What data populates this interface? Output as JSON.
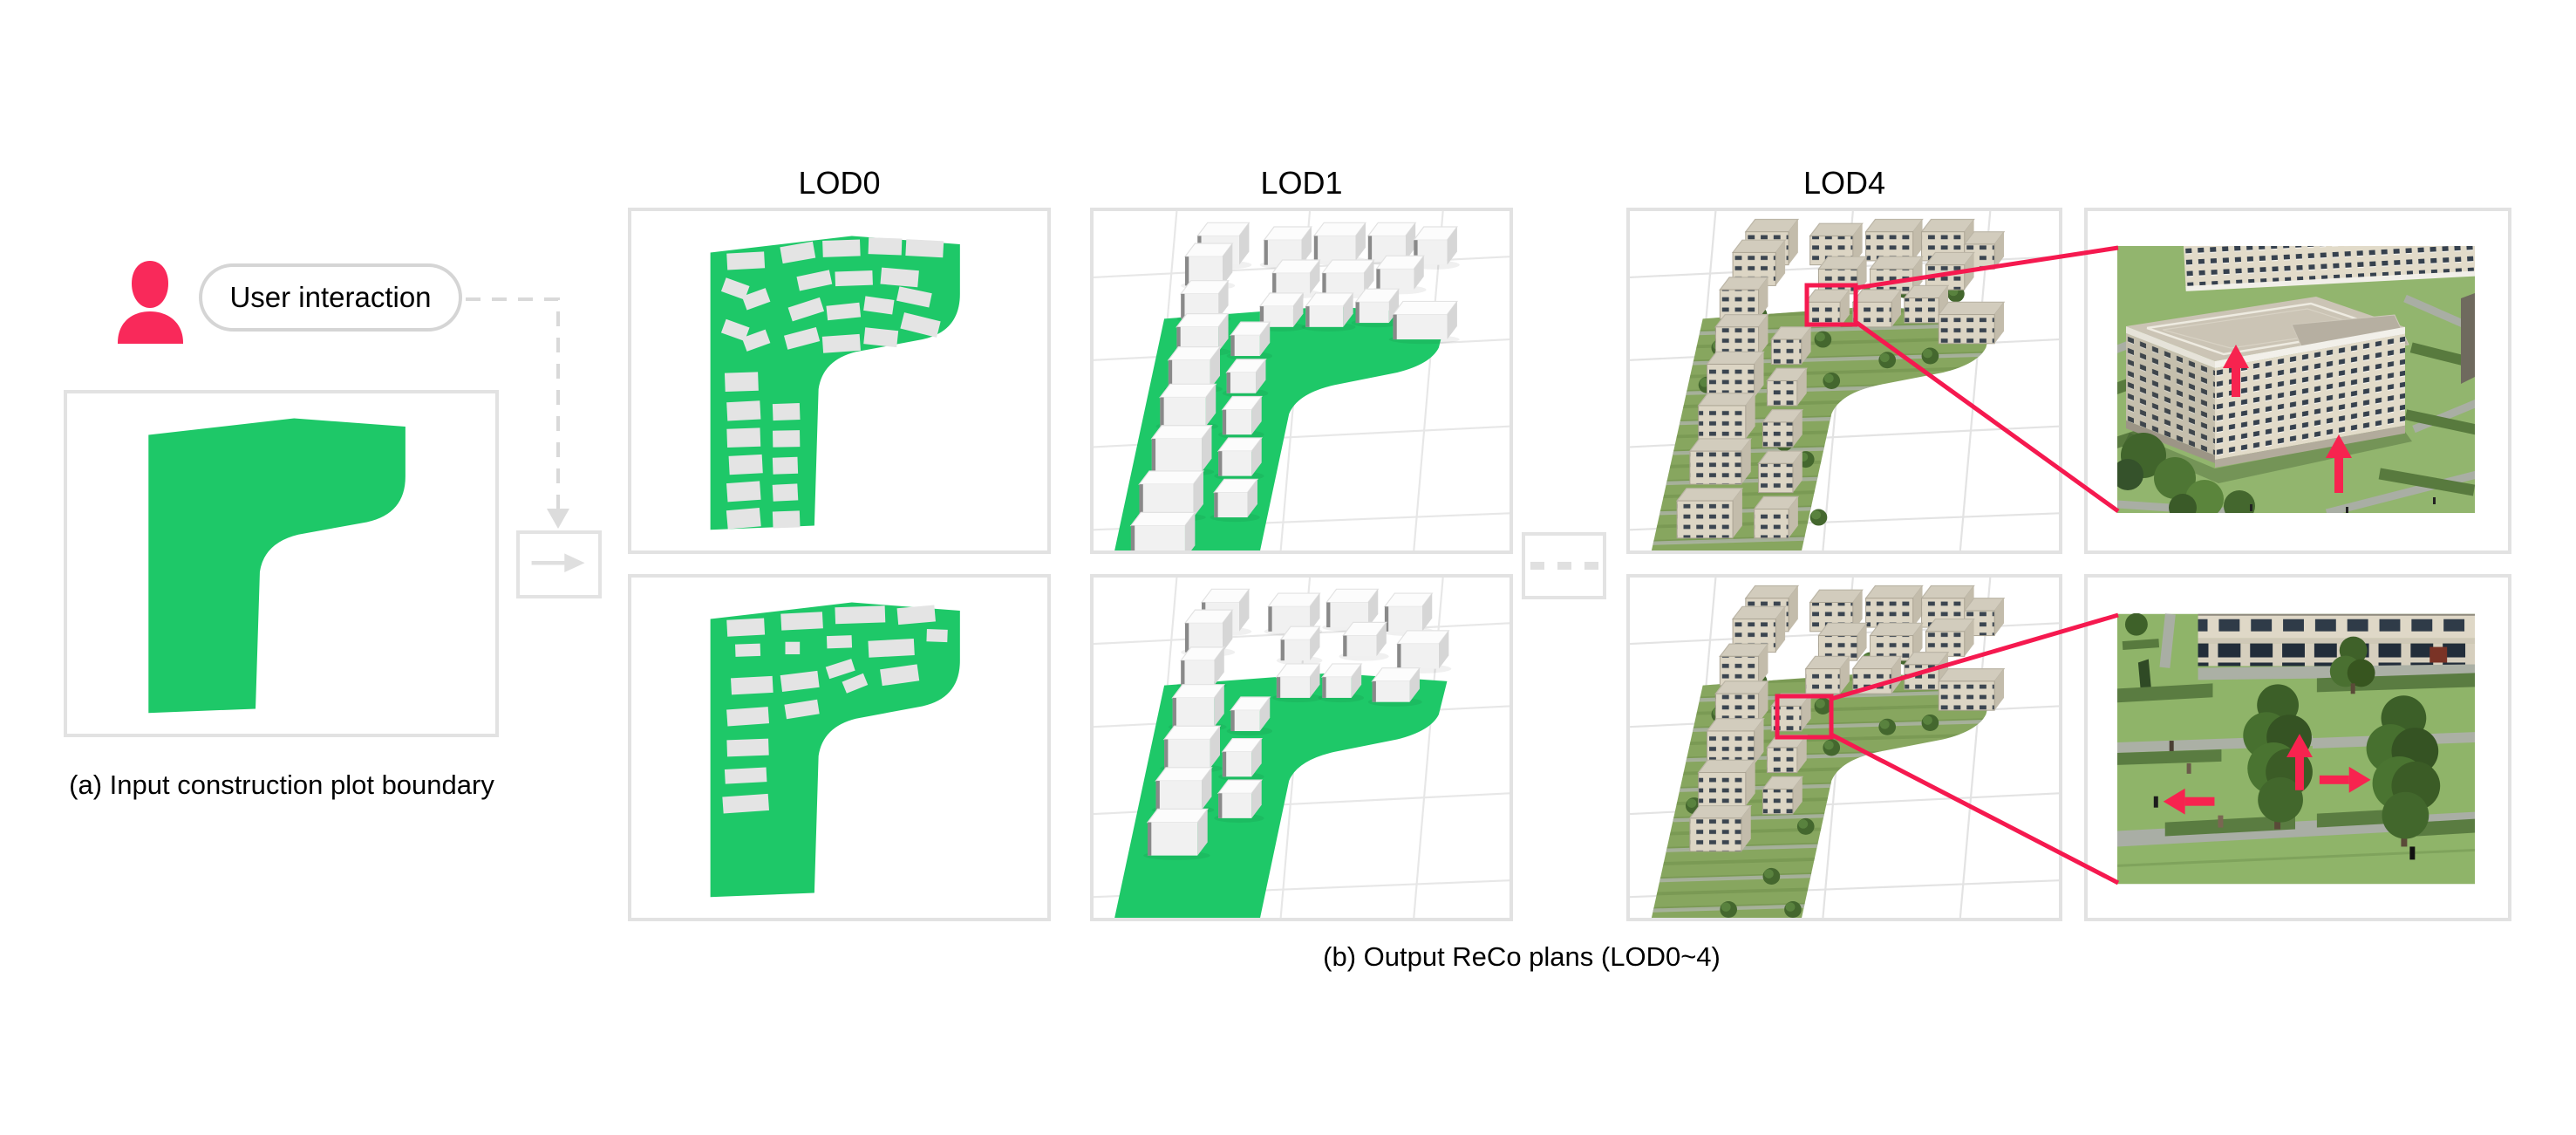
{
  "user_interaction_label": "User interaction",
  "lod_labels": [
    "LOD0",
    "LOD1",
    "LOD4"
  ],
  "captions": {
    "a": "(a) Input construction plot boundary",
    "b": "(b) Output ReCo plans (LOD0~4)"
  },
  "icons": {
    "person": "person-icon",
    "arrow_right": "→",
    "arrow_down": "▼",
    "ellipsis": "- - -"
  },
  "colors": {
    "plot_green": "#1EC868",
    "callout_red": "#F5194F",
    "person_pink": "#F9295A",
    "panel_border": "#E2E2E2",
    "connector_gray": "#D9D9D9",
    "lod4_lawn": "#87A65F",
    "building_beige": "#DCD5C4",
    "text": "#111111"
  }
}
